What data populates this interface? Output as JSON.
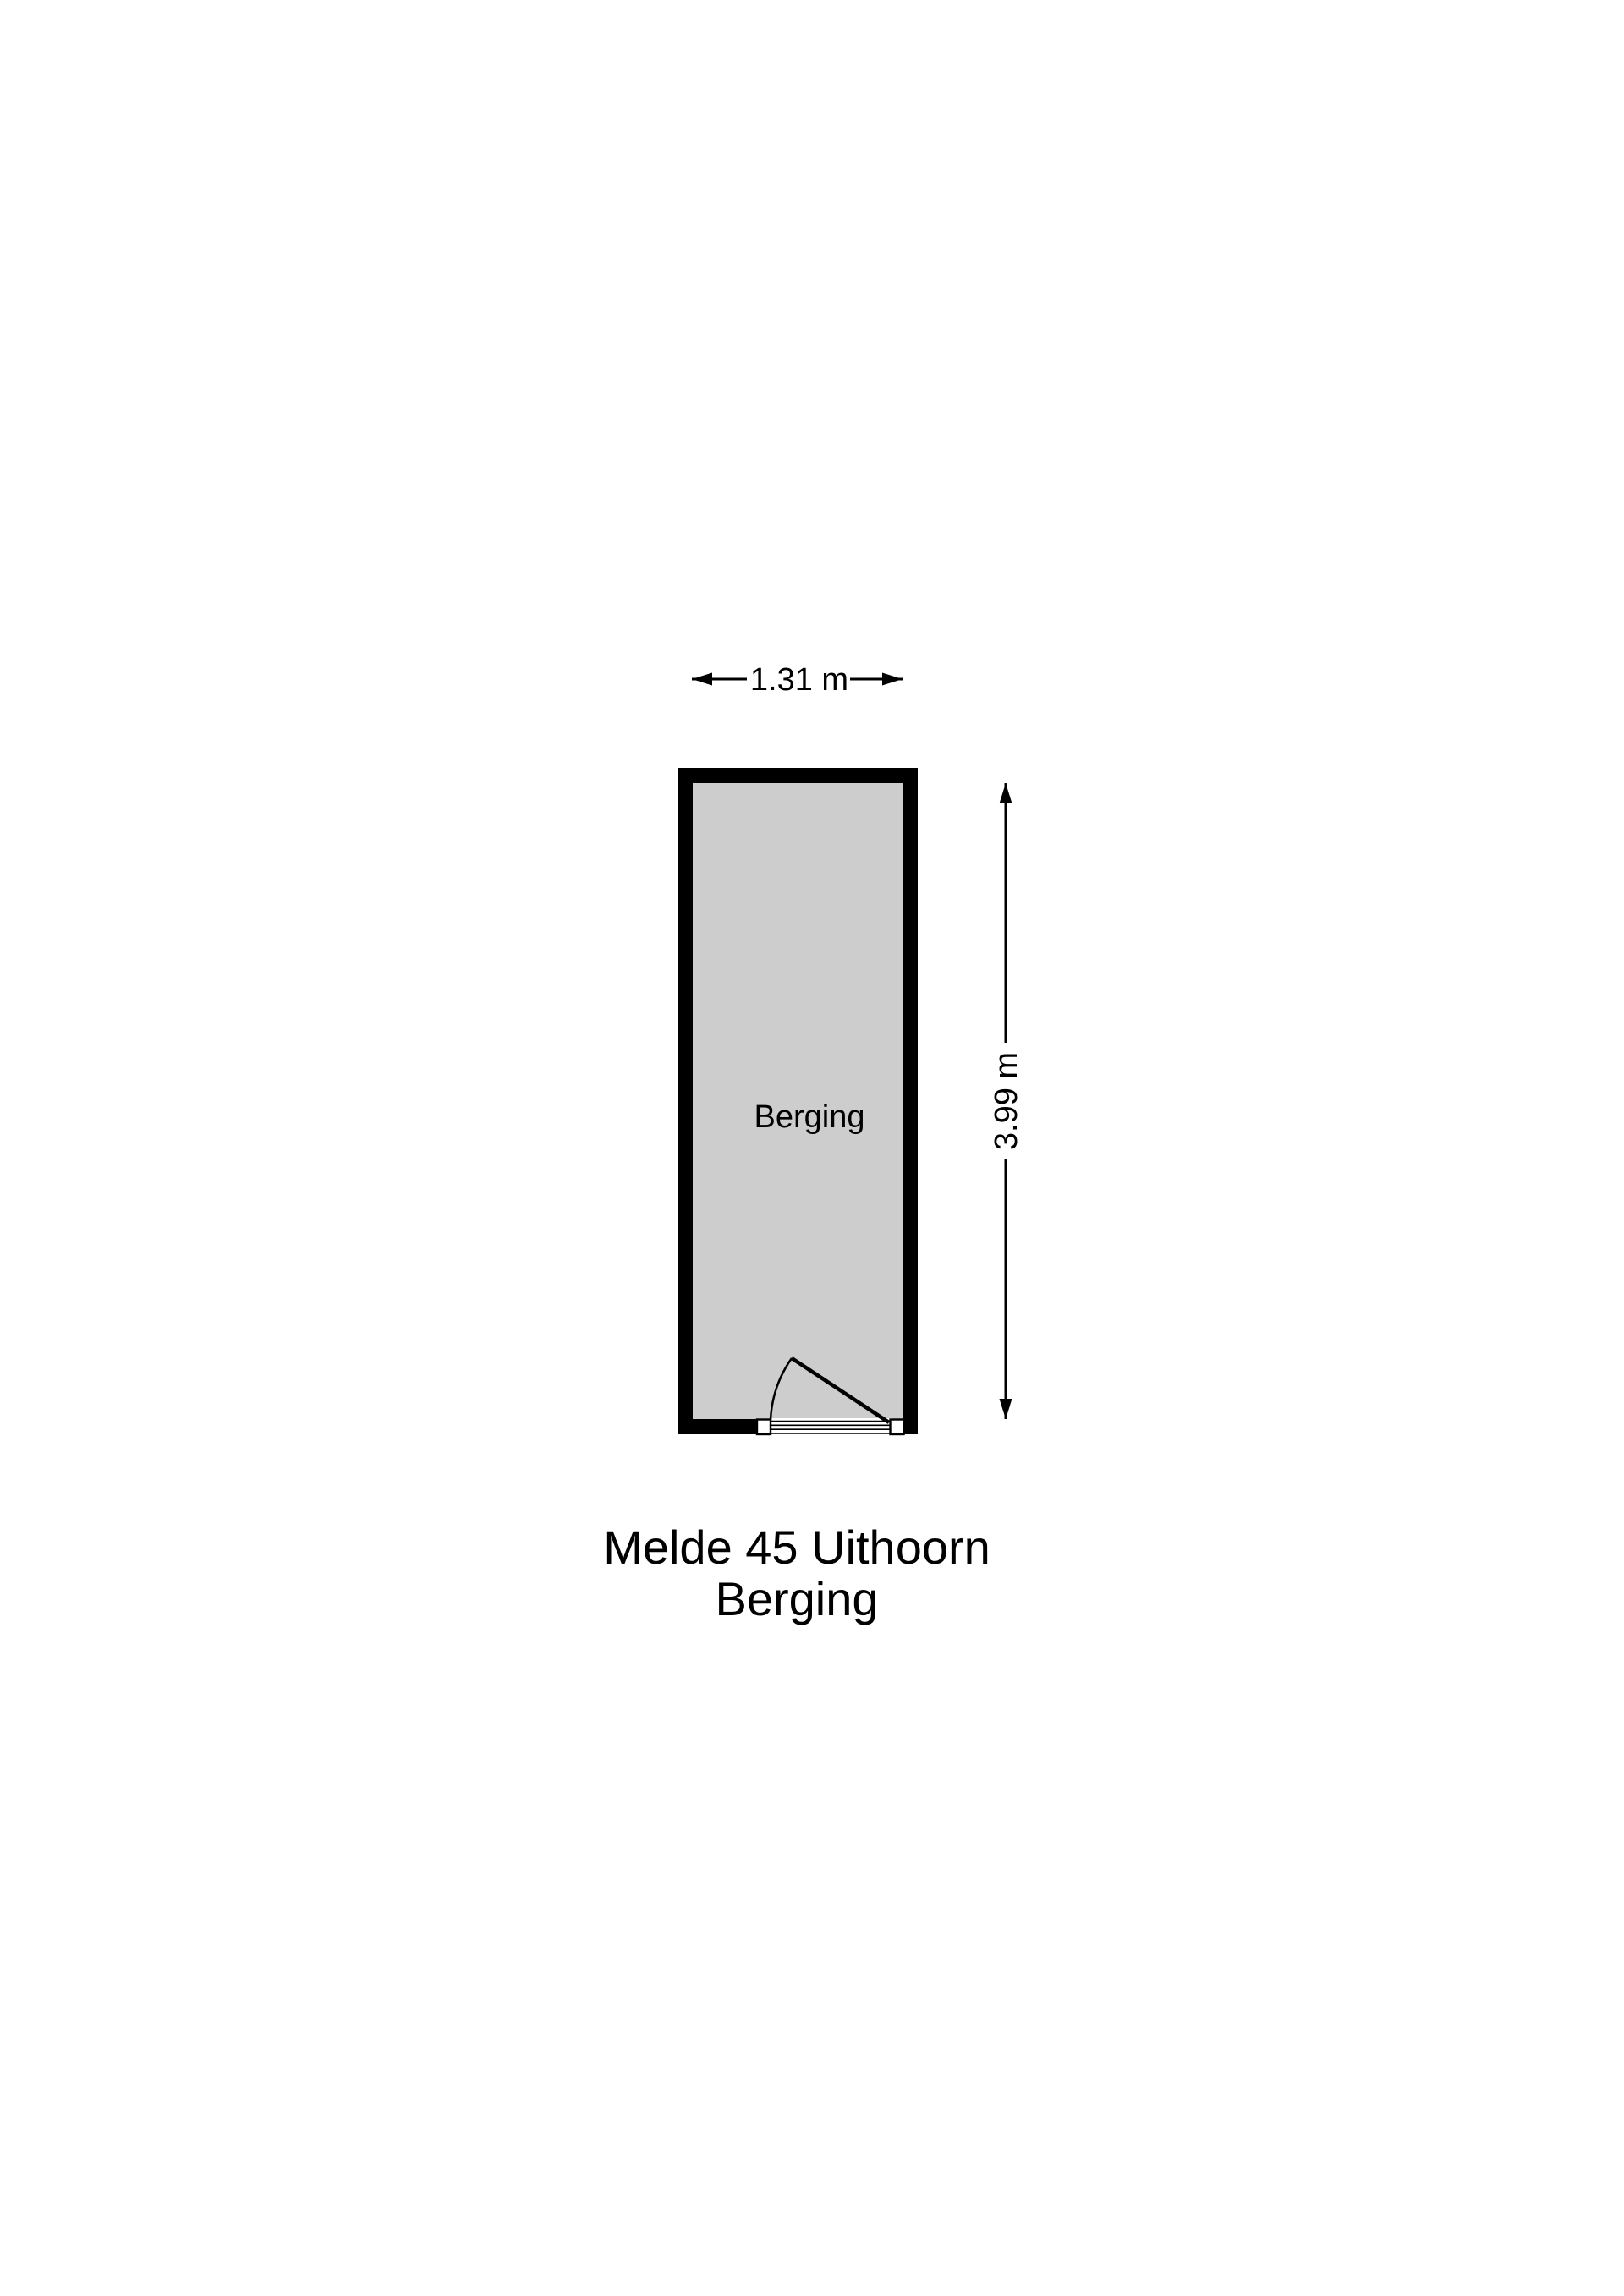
{
  "floorplan": {
    "room": {
      "label": "Berging",
      "floor_color": "#cdcdcd",
      "wall_color": "#000000"
    },
    "dimensions": {
      "width": "1.31 m",
      "height": "3.99 m"
    },
    "caption": {
      "line1": "Melde 45 Uithoorn",
      "line2": "Berging"
    },
    "colors": {
      "line": "#000000",
      "background": "#ffffff"
    }
  }
}
